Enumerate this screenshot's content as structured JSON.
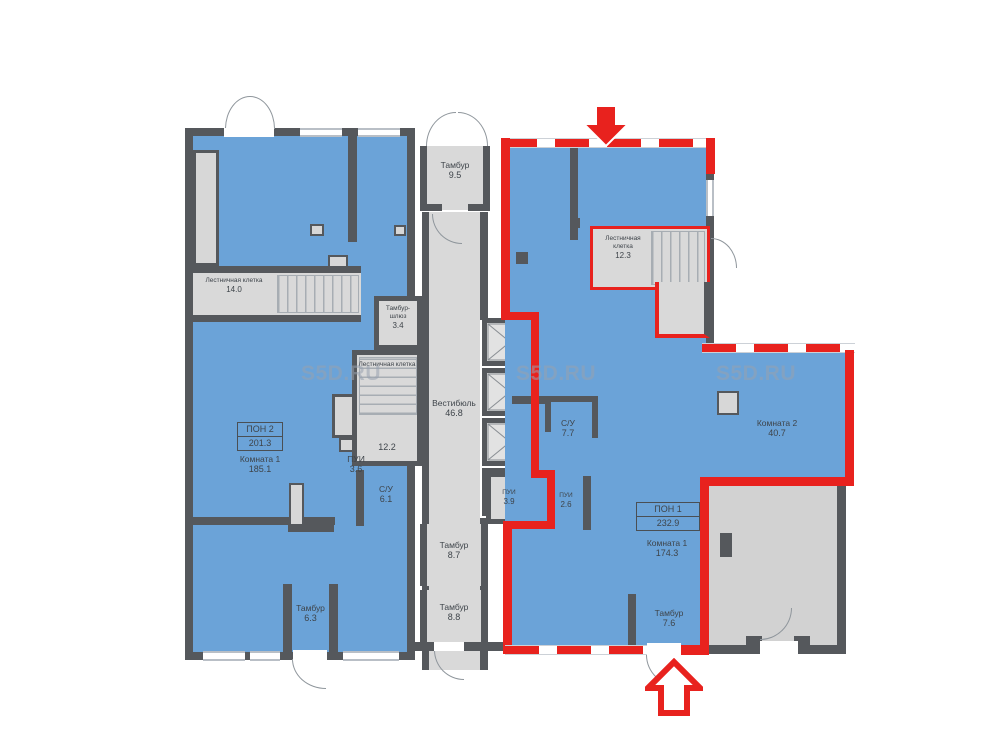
{
  "watermark": "S5D.RU",
  "colors": {
    "blue": "#6ba3d8",
    "wall": "#55585c",
    "gray": "#d9d9d9",
    "red": "#e8221e"
  },
  "left_unit": {
    "stair_name": "Лестничная клетка",
    "stair_area": "14.0",
    "unit_code": "ПОН 2",
    "unit_area": "201.3",
    "room1_name": "Комната 1",
    "room1_area": "185.1",
    "pui_name": "ПУИ",
    "pui_area": "3.6",
    "su_name": "С/У",
    "su_area": "6.1",
    "tambour_name": "Тамбур",
    "tambour_area": "6.3"
  },
  "core": {
    "tambour_top_name": "Тамбур",
    "tambour_top_area": "9.5",
    "lock_name": "Тамбур-шлюз",
    "lock_area": "3.4",
    "stair_name": "Лестничная клетка",
    "stair_area": "12.2",
    "vestibule_name": "Вестибюль",
    "vestibule_area": "46.8",
    "pui_name": "ПУИ",
    "pui_area": "3.9",
    "tambour1_name": "Тамбур",
    "tambour1_area": "8.7",
    "tambour2_name": "Тамбур",
    "tambour2_area": "8.8"
  },
  "right_unit": {
    "stair_name": "Лестничная клетка",
    "stair_area": "12.3",
    "su_name": "С/У",
    "su_area": "7.7",
    "pui_name": "ПУИ",
    "pui_area": "2.6",
    "unit_code": "ПОН 1",
    "unit_area": "232.9",
    "room1_name": "Комната 1",
    "room1_area": "174.3",
    "room2_name": "Комната 2",
    "room2_area": "40.7",
    "tambour_name": "Тамбур",
    "tambour_area": "7.6"
  }
}
